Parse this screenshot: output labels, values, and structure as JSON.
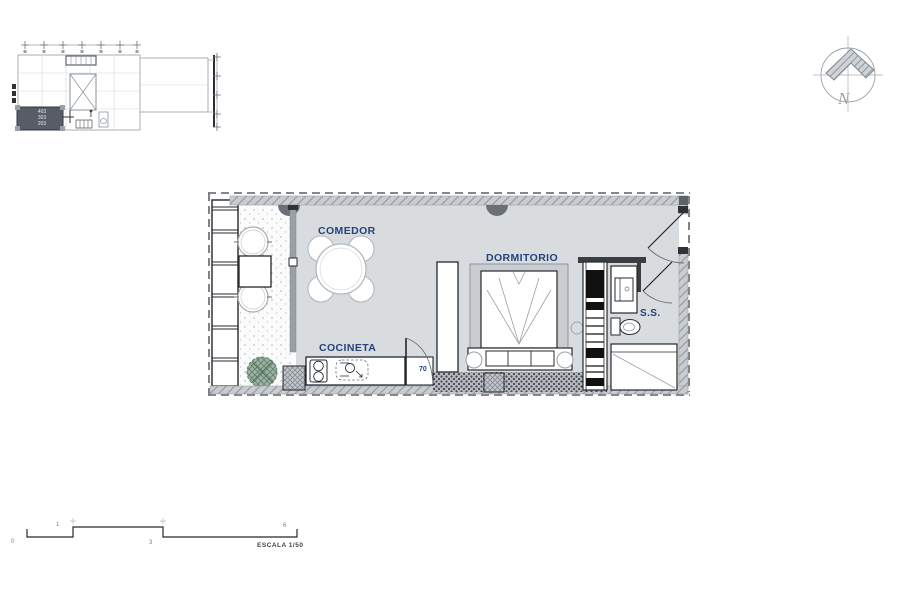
{
  "colors": {
    "label_blue": "#24427c",
    "floor_gray": "#d9dcdf",
    "wall_hatch_gray": "#c9cdd1",
    "dark_column_gray": "#6a7076",
    "line_dark": "#24282c",
    "line_light": "#a8aeb4",
    "tree_green": "#5f7d68",
    "key_unit_fill": "#575d66"
  },
  "key_plan": {
    "unit_numbers": [
      "403",
      "303",
      "203"
    ]
  },
  "north_arrow": {
    "label": "N"
  },
  "floor_plan": {
    "rooms": [
      {
        "id": "comedor",
        "label": "COMEDOR"
      },
      {
        "id": "dormitorio",
        "label": "DORMITORIO"
      },
      {
        "id": "cocineta",
        "label": "COCINETA"
      },
      {
        "id": "ss",
        "label": "S.S."
      }
    ],
    "door_dimension": "70"
  },
  "scale_bar": {
    "tick_labels": [
      "0",
      "1",
      "3",
      "6"
    ],
    "caption": "ESCALA 1/50"
  }
}
